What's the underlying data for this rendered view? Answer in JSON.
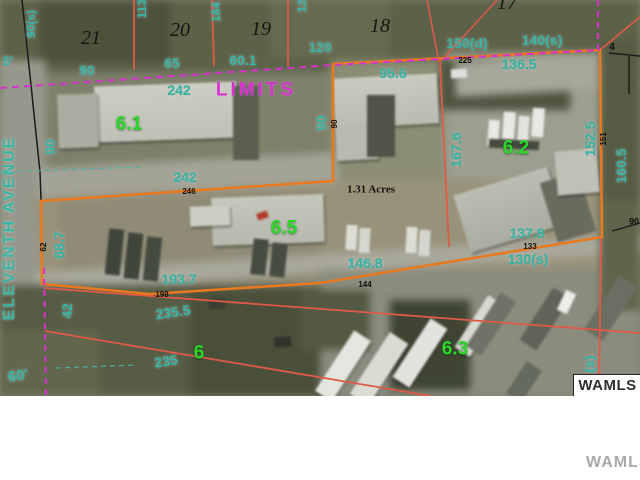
{
  "watermark": {
    "photo_label": "WAMLS",
    "footer_label": "WAMLS"
  },
  "colors": {
    "parcel_boundary_orange": "#e8791f",
    "lot_line_red": "#e05a48",
    "city_limits_magenta": "#d633cc",
    "dimension_text_teal": "#3ab5a5",
    "parcel_number_green": "#2ad82a",
    "ground_olive": "#7e806b"
  },
  "map": {
    "acreage_label": "1.31 Acres",
    "city_limits_label": "LIMITS",
    "street_label": "ELEVENTH AVENUE",
    "parcel_numbers": [
      "6.1",
      "6.2",
      "6.5",
      "6.3",
      "6"
    ],
    "lot_numbers": [
      "21",
      "20",
      "19",
      "18",
      "17"
    ],
    "labels": [
      {
        "text": "90(s)",
        "style": "t",
        "x": 31,
        "y": 24,
        "rot": -90,
        "size": 12
      },
      {
        "text": "5'",
        "style": "t",
        "x": 8,
        "y": 61,
        "size": 13
      },
      {
        "text": "90",
        "style": "t",
        "x": 87,
        "y": 70
      },
      {
        "text": "65",
        "style": "t",
        "x": 172,
        "y": 63
      },
      {
        "text": "60.1",
        "style": "t",
        "x": 243,
        "y": 60
      },
      {
        "text": "120",
        "style": "t",
        "x": 320,
        "y": 47
      },
      {
        "text": "150(d)",
        "style": "t",
        "x": 467,
        "y": 43
      },
      {
        "text": "140(s)",
        "style": "t",
        "x": 542,
        "y": 40
      },
      {
        "text": "95.6",
        "style": "t",
        "x": 393,
        "y": 73
      },
      {
        "text": "136.5",
        "style": "t",
        "x": 519,
        "y": 64
      },
      {
        "text": "242",
        "style": "t",
        "x": 179,
        "y": 90
      },
      {
        "text": "113",
        "style": "t",
        "x": 142,
        "y": 9,
        "rot": -90,
        "size": 12
      },
      {
        "text": "184",
        "style": "t",
        "x": 216,
        "y": 12,
        "rot": -90,
        "size": 12
      },
      {
        "text": "12",
        "style": "t",
        "x": 302,
        "y": 6,
        "rot": -90,
        "size": 12
      },
      {
        "text": "21",
        "style": "k",
        "x": 91,
        "y": 38
      },
      {
        "text": "20",
        "style": "k",
        "x": 180,
        "y": 30
      },
      {
        "text": "19",
        "style": "k",
        "x": 261,
        "y": 29
      },
      {
        "text": "18",
        "style": "k",
        "x": 380,
        "y": 26
      },
      {
        "text": "17",
        "style": "k",
        "x": 507,
        "y": 3
      },
      {
        "text": "225",
        "style": "d",
        "x": 465,
        "y": 61
      },
      {
        "text": "4",
        "style": "d",
        "x": 612,
        "y": 48,
        "size": 10
      },
      {
        "text": "LIMITS",
        "style": "m",
        "x": 256,
        "y": 90
      },
      {
        "text": "6.1",
        "style": "g",
        "x": 129,
        "y": 124
      },
      {
        "text": "90",
        "style": "t",
        "x": 321,
        "y": 123,
        "rot": -90
      },
      {
        "text": "90",
        "style": "d",
        "x": 335,
        "y": 124,
        "rot": -90
      },
      {
        "text": "90",
        "style": "t",
        "x": 50,
        "y": 147,
        "rot": -90
      },
      {
        "text": "167.6",
        "style": "t",
        "x": 456,
        "y": 150,
        "rot": -90
      },
      {
        "text": "6.2",
        "style": "g",
        "x": 516,
        "y": 148
      },
      {
        "text": "152.5",
        "style": "t",
        "x": 590,
        "y": 139,
        "rot": -90
      },
      {
        "text": "151",
        "style": "d",
        "x": 604,
        "y": 139,
        "rot": -90
      },
      {
        "text": "160.5",
        "style": "t",
        "x": 621,
        "y": 166,
        "rot": -90
      },
      {
        "text": "242",
        "style": "t",
        "x": 185,
        "y": 177
      },
      {
        "text": "246",
        "style": "d",
        "x": 189,
        "y": 192
      },
      {
        "text": "1.31 Acres",
        "style": "a",
        "x": 371,
        "y": 190
      },
      {
        "text": "68.7",
        "style": "t",
        "x": 59,
        "y": 245,
        "rot": -90
      },
      {
        "text": "62",
        "style": "d",
        "x": 44,
        "y": 247,
        "rot": -90
      },
      {
        "text": "6.5",
        "style": "g",
        "x": 284,
        "y": 228
      },
      {
        "text": "137.8",
        "style": "t",
        "x": 527,
        "y": 233
      },
      {
        "text": "133",
        "style": "d",
        "x": 530,
        "y": 247
      },
      {
        "text": "130(s)",
        "style": "t",
        "x": 528,
        "y": 259
      },
      {
        "text": "90",
        "style": "d",
        "x": 634,
        "y": 222,
        "size": 9
      },
      {
        "text": "146.8",
        "style": "t",
        "x": 365,
        "y": 263
      },
      {
        "text": "144",
        "style": "d",
        "x": 365,
        "y": 285
      },
      {
        "text": "193.7",
        "style": "t",
        "x": 179,
        "y": 279
      },
      {
        "text": "198",
        "style": "d",
        "x": 162,
        "y": 295
      },
      {
        "text": "42",
        "style": "t",
        "x": 67,
        "y": 311,
        "rot": -90
      },
      {
        "text": "235.5",
        "style": "t",
        "x": 173,
        "y": 312,
        "rot": -8
      },
      {
        "text": "6",
        "style": "g",
        "x": 199,
        "y": 353
      },
      {
        "text": "235",
        "style": "t",
        "x": 166,
        "y": 361,
        "rot": -8
      },
      {
        "text": "6.3",
        "style": "g",
        "x": 455,
        "y": 349
      },
      {
        "text": "60'",
        "style": "t",
        "x": 18,
        "y": 376,
        "rot": -8,
        "size": 15
      },
      {
        "text": "(s)",
        "style": "t",
        "x": 589,
        "y": 364,
        "rot": -90
      },
      {
        "text": "ELEVENTH AVENUE",
        "style": "st",
        "x": 10,
        "y": 228,
        "rot": -90
      }
    ]
  }
}
